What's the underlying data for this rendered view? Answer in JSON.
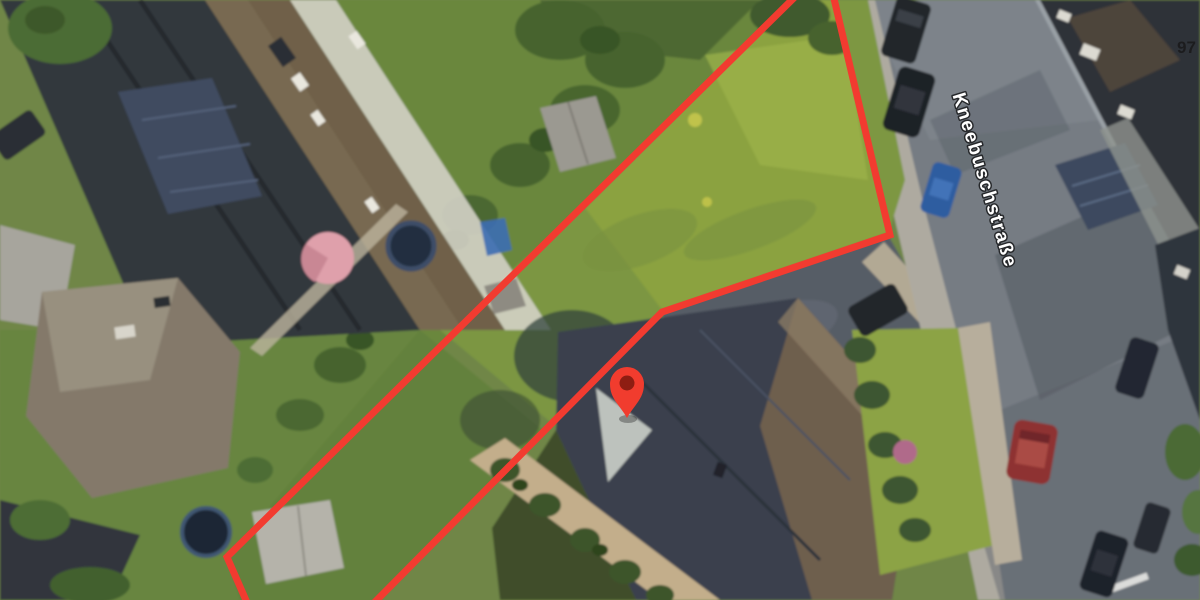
{
  "map": {
    "kind": "satellite-map-view",
    "street_label": "Kneebuschstraße",
    "house_number": "97",
    "marker": {
      "name": "location-pin",
      "color": "#f13c2e",
      "inner_color": "#8e1d12",
      "transform": "translate(627,418)"
    },
    "boundary": {
      "color": "#f23b30",
      "width": 7,
      "left_points": "806,-14 227,557 252,614",
      "right_points": "831,-14 890,235 662,312 363,614"
    },
    "label_style": {
      "street_color": "#ffffff",
      "street_outline": "#26282b",
      "number_color": "#1c1c1e"
    }
  }
}
